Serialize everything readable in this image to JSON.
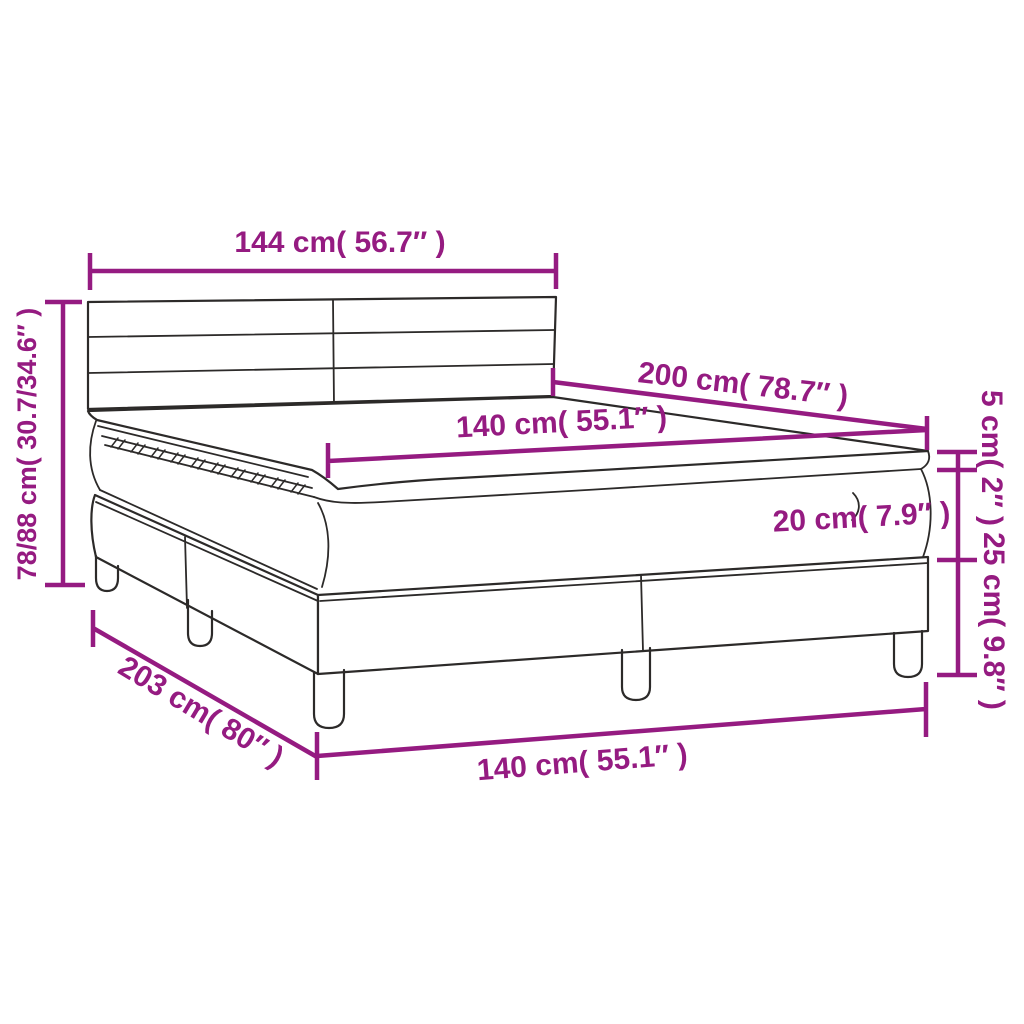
{
  "title": "Box spring bed with topper dimension diagram",
  "colors": {
    "accent": "#951b81",
    "line": "#2c2a29",
    "background": "#ffffff"
  },
  "dimensions": {
    "headboard_width": "144 cm( 56.7″ )",
    "total_height": "78/88 cm( 30.7/34.6″ )",
    "length": "200 cm( 78.7″ )",
    "width_top": "140 cm( 55.1″ )",
    "topper_height": "5 cm( 2″ )",
    "mattress_height": "20 cm( 7.9″ )",
    "base_height": "25 cm( 9.8″ )",
    "base_diagonal_length": "203 cm( 80″ )",
    "width_bottom": "140 cm( 55.1″ )"
  }
}
